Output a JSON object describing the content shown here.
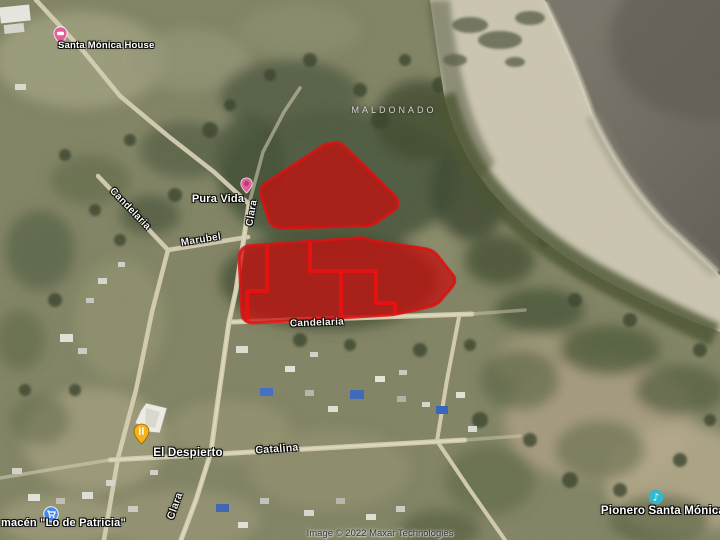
{
  "map": {
    "region_label": "MALDONADO",
    "attribution": "Image © 2022 Maxar Technologies",
    "pois": {
      "santa_monica_house": {
        "label": "Santa Mónica House",
        "icon": "lodging-pin"
      },
      "pura_vida": {
        "label": "Pura Vida",
        "icon": "place-pin"
      },
      "el_despierto": {
        "label": "El Despierto",
        "icon": "restaurant-pin"
      },
      "lo_de_patricia": {
        "label": "macén \"Lo de Patricia\"",
        "icon": "grocery-icon"
      },
      "pionero_santa_monica": {
        "label": "Pionero Santa Mónica",
        "icon": "music-icon"
      }
    },
    "streets": {
      "clara": "Clara",
      "marubel": "Marubel",
      "candelaria": "Candelaria",
      "catalina": "Catalina"
    },
    "highlight": {
      "description": "two red highlighted land parcels",
      "fill_color": "#c60e0e",
      "outline_color": "#dc1212",
      "parcel_line_color": "#ea1111",
      "parcel_count": 2
    },
    "icon_colors": {
      "lodging_pin": "#e45e9b",
      "place_pin": "#e45e9b",
      "restaurant_pin": "#f5b31b",
      "grocery_icon": "#4687f0",
      "music_icon": "#35b7cd"
    }
  }
}
